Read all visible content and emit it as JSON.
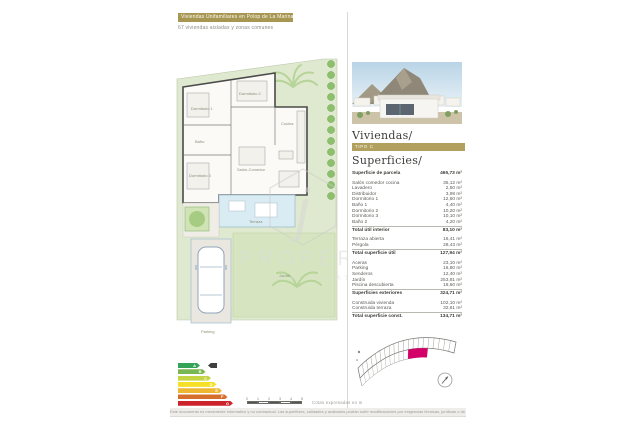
{
  "header": {
    "title": "Viviendas Unifamiliares en Polop de La Marina",
    "subtitle": "67 viviendas aisladas y zonas comunes"
  },
  "right_panel": {
    "viviendas_heading": "Viviendas/",
    "tipo_label": "TIPO C",
    "superficies_heading": "Superficies/"
  },
  "surfaces": {
    "parcela": {
      "label": "Superficie de parcela",
      "value": "465,73 m²"
    },
    "groups": [
      {
        "rows": [
          [
            "Salón comedor cocina",
            "35,12 m²"
          ],
          [
            "Lavadero",
            "2,50 m²"
          ],
          [
            "Distribuidor",
            "3,98 m²"
          ],
          [
            "Dormitorio 1",
            "12,60 m²"
          ],
          [
            "Baño 1",
            "4,40 m²"
          ],
          [
            "Dormitorio 2",
            "10,20 m²"
          ],
          [
            "Dormitorio 3",
            "10,10 m²"
          ],
          [
            "Baño 2",
            "4,20 m²"
          ]
        ],
        "total": [
          "Total útil interior",
          "83,10 m²"
        ]
      },
      {
        "rows": [
          [
            "Terraza abierta",
            "16,41 m²"
          ],
          [
            "Pérgola",
            "28,43 m²"
          ]
        ],
        "total": [
          "Total superficie útil",
          "127,94 m²"
        ]
      },
      {
        "rows": [
          [
            "Aceras",
            "23,10 m²"
          ],
          [
            "Parking",
            "16,80 m²"
          ],
          [
            "Senderos",
            "12,40 m²"
          ],
          [
            "Jardín",
            "253,81 m²"
          ],
          [
            "Piscina descubierta",
            "18,60 m²"
          ]
        ],
        "total": [
          "Superficies exteriores",
          "324,71 m²"
        ]
      },
      {
        "rows": [
          [
            "Construida vivienda",
            "102,10 m²"
          ],
          [
            "Construida terraza",
            "32,61 m²"
          ]
        ],
        "total": [
          "Total superficie const.",
          "134,71 m²"
        ]
      }
    ]
  },
  "plan": {
    "labels": [
      "Dormitorio 1",
      "Dormitorio 2",
      "Dormitorio 3",
      "Baño",
      "Salón-Comedor",
      "Cocina",
      "Terraza",
      "Jardín",
      "Parking"
    ]
  },
  "watermark": {
    "initial": "j",
    "brand": "PROPERTIES",
    "tagline": "REAL ESTATE"
  },
  "energy": {
    "letters": [
      "A",
      "B",
      "C",
      "D",
      "E",
      "F",
      "G"
    ],
    "colors": [
      "#33a357",
      "#79b752",
      "#c3d545",
      "#f5e027",
      "#edb731",
      "#d66f2c",
      "#cc232a"
    ],
    "marker_color": "#3f3f3f",
    "rating_row": 0
  },
  "scale": {
    "labels": [
      "0",
      "1",
      "2",
      "3",
      "4",
      "5"
    ],
    "caption": "Cotas expresadas en m"
  },
  "footer": {
    "disclaimer": "Este documento es meramente informativo y no contractual. Las superficies, calidades y acabados podrán sufrir modificaciones por exigencias técnicas, jurídicas o de la dirección facultativa."
  },
  "colors": {
    "accent_gold": "#a89653",
    "highlight_magenta": "#d4006a",
    "garden_green": "#dfe9cf"
  }
}
